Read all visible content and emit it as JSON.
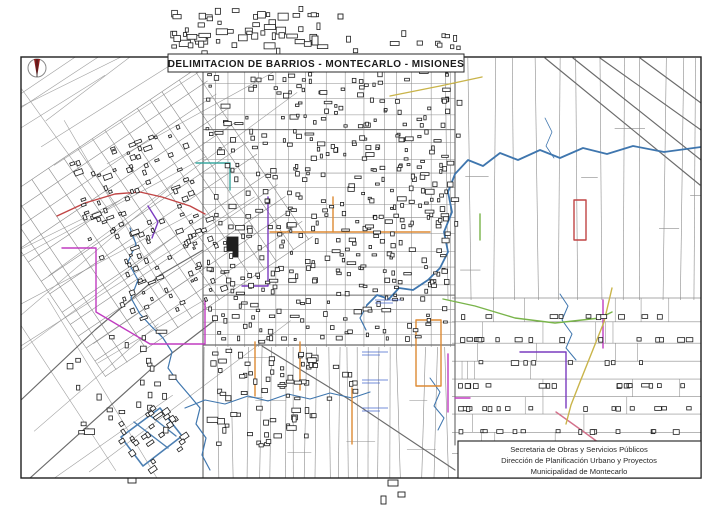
{
  "title": "DELIMITACION DE BARRIOS - MONTECARLO - MISIONES",
  "title_block": {
    "lines": [
      "Secretaria de Obras y Servicios Públicos",
      "Dirección de Planificación Urbano y Proyectos",
      "Municipalidad de Montecarlo"
    ]
  },
  "icons": {
    "north_arrow": "compass-needle-icon"
  },
  "colors": {
    "frame": "#1e1e1e",
    "road": "#8c8c8c",
    "road_major": "#6b6b6b",
    "building": "#1f1f1f",
    "river": "#3f76ae",
    "magenta": "#c03cc0",
    "purple": "#7a3bbf",
    "orange": "#dd8a33",
    "green": "#79b44a",
    "red": "#c04545",
    "pink": "#d4728c",
    "yellow": "#c9b44a",
    "teal": "#3aa8a0",
    "steel": "#4c7fb2",
    "blue_label": "#4466cc",
    "arrow_red": "#8b1c1c"
  },
  "map": {
    "frame": {
      "x": 21,
      "y": 57,
      "w": 680,
      "h": 421
    },
    "regions": [
      {
        "t": "diag",
        "seed": 11,
        "x": 21,
        "y": 58,
        "w": 200,
        "h": 420,
        "angle": -34,
        "n": 24
      },
      {
        "t": "gridr",
        "seed": 7,
        "cx": 152,
        "cy": 222,
        "w": 250,
        "h": 205,
        "angle": -34,
        "cell": 18
      },
      {
        "t": "grid",
        "seed": 3,
        "x": 203,
        "y": 60,
        "w": 252,
        "h": 287,
        "cw": 17,
        "ch": 14
      },
      {
        "t": "vpar",
        "seed": 5,
        "x": 203,
        "y": 347,
        "w": 165,
        "h": 131,
        "sp": 13,
        "tilt": 6
      },
      {
        "t": "vpar",
        "seed": 6,
        "x": 368,
        "y": 347,
        "w": 86,
        "h": 131,
        "sp": 16,
        "tilt": 8
      },
      {
        "t": "vpar",
        "seed": 9,
        "x": 448,
        "y": 58,
        "w": 253,
        "h": 242,
        "sp": 18,
        "tilt": 9
      },
      {
        "t": "hstr",
        "seed": 13,
        "x": 452,
        "y": 298,
        "w": 249,
        "h": 147,
        "rh": 23
      }
    ],
    "major_lines": [
      [
        [
          203,
          345
        ],
        [
          455,
          345
        ]
      ],
      [
        [
          203,
          60
        ],
        [
          203,
          478
        ]
      ],
      [
        [
          455,
          60
        ],
        [
          455,
          445
        ]
      ],
      [
        [
          262,
          346
        ],
        [
          350,
          400
        ],
        [
          455,
          470
        ]
      ],
      [
        [
          21,
          400
        ],
        [
          95,
          330
        ],
        [
          160,
          275
        ],
        [
          203,
          250
        ]
      ],
      [
        [
          30,
          478
        ],
        [
          150,
          370
        ],
        [
          215,
          320
        ]
      ],
      [
        [
          573,
          58
        ],
        [
          701,
          160
        ]
      ],
      [
        [
          600,
          58
        ],
        [
          701,
          130
        ]
      ],
      [
        [
          640,
          58
        ],
        [
          701,
          103
        ]
      ],
      [
        [
          545,
          58
        ],
        [
          700,
          185
        ]
      ]
    ],
    "rivers": [
      {
        "w": 1.8,
        "p": [
          [
            701,
            147
          ],
          [
            664,
            152
          ],
          [
            633,
            146
          ],
          [
            607,
            154
          ],
          [
            583,
            148
          ],
          [
            560,
            158
          ],
          [
            540,
            150
          ],
          [
            518,
            160
          ],
          [
            500,
            153
          ],
          [
            483,
            166
          ],
          [
            468,
            160
          ],
          [
            455,
            174
          ],
          [
            448,
            192
          ],
          [
            452,
            212
          ],
          [
            444,
            232
          ],
          [
            448,
            252
          ],
          [
            440,
            268
          ],
          [
            428,
            280
          ],
          [
            413,
            290
          ],
          [
            399,
            288
          ],
          [
            389,
            299
          ],
          [
            377,
            295
          ],
          [
            367,
            305
          ]
        ]
      },
      {
        "w": 1.2,
        "p": [
          [
            130,
            228
          ],
          [
            136,
            244
          ],
          [
            128,
            262
          ],
          [
            138,
            280
          ],
          [
            131,
            298
          ],
          [
            140,
            314
          ],
          [
            151,
            326
          ],
          [
            163,
            338
          ],
          [
            172,
            352
          ],
          [
            168,
            368
          ],
          [
            178,
            382
          ],
          [
            190,
            396
          ],
          [
            200,
            408
          ],
          [
            196,
            424
          ],
          [
            206,
            438
          ],
          [
            202,
            455
          ],
          [
            210,
            470
          ]
        ]
      },
      {
        "w": 1.1,
        "p": [
          [
            185,
            408
          ],
          [
            205,
            400
          ],
          [
            225,
            404
          ],
          [
            248,
            396
          ],
          [
            268,
            401
          ],
          [
            288,
            394
          ],
          [
            310,
            399
          ],
          [
            330,
            393
          ],
          [
            352,
            398
          ],
          [
            370,
            392
          ]
        ]
      },
      {
        "w": 1.0,
        "p": [
          [
            560,
            294
          ],
          [
            568,
            306
          ],
          [
            562,
            320
          ],
          [
            572,
            334
          ],
          [
            566,
            348
          ],
          [
            576,
            360
          ]
        ]
      },
      {
        "w": 1.0,
        "p": [
          [
            430,
            378
          ],
          [
            440,
            392
          ],
          [
            434,
            406
          ],
          [
            444,
            418
          ],
          [
            438,
            430
          ]
        ]
      },
      {
        "w": 0.8,
        "p": [
          [
            545,
            118
          ],
          [
            552,
            132
          ],
          [
            546,
            146
          ],
          [
            554,
            158
          ]
        ]
      },
      {
        "w": 1.2,
        "p": [
          [
            367,
            305
          ],
          [
            360,
            318
          ],
          [
            366,
            330
          ]
        ]
      }
    ],
    "boundaries": [
      {
        "c": "magenta",
        "p": [
          [
            62,
            248
          ],
          [
            96,
            248
          ],
          [
            96,
            312
          ],
          [
            150,
            344
          ],
          [
            205,
            344
          ],
          [
            205,
            300
          ]
        ]
      },
      {
        "c": "magenta",
        "p": [
          [
            448,
            354
          ],
          [
            448,
            412
          ]
        ]
      },
      {
        "c": "magenta",
        "p": [
          [
            455,
            398
          ],
          [
            470,
            398
          ]
        ]
      },
      {
        "c": "magenta",
        "p": [
          [
            603,
            300
          ],
          [
            603,
            348
          ]
        ]
      },
      {
        "c": "purple",
        "p": [
          [
            268,
            197
          ],
          [
            268,
            286
          ],
          [
            242,
            286
          ]
        ]
      },
      {
        "c": "purple",
        "p": [
          [
            520,
            352
          ],
          [
            566,
            352
          ],
          [
            566,
            408
          ]
        ]
      },
      {
        "c": "purple",
        "p": [
          [
            148,
            206
          ],
          [
            158,
            222
          ],
          [
            152,
            238
          ]
        ]
      },
      {
        "c": "orange",
        "p": [
          [
            270,
            232
          ],
          [
            430,
            232
          ]
        ]
      },
      {
        "c": "orange",
        "p": [
          [
            333,
            197
          ],
          [
            333,
            232
          ]
        ]
      },
      {
        "c": "orange",
        "closed": true,
        "p": [
          [
            416,
            320
          ],
          [
            441,
            320
          ],
          [
            441,
            386
          ],
          [
            416,
            386
          ]
        ]
      },
      {
        "c": "orange",
        "p": [
          [
            352,
            388
          ],
          [
            352,
            444
          ]
        ]
      },
      {
        "c": "orange",
        "p": [
          [
            255,
            342
          ],
          [
            255,
            396
          ]
        ]
      },
      {
        "c": "orange",
        "p": [
          [
            300,
            342
          ],
          [
            300,
            390
          ]
        ]
      },
      {
        "c": "green",
        "p": [
          [
            443,
            299
          ],
          [
            475,
            306
          ],
          [
            515,
            318
          ],
          [
            555,
            323
          ],
          [
            600,
            318
          ],
          [
            612,
            312
          ]
        ]
      },
      {
        "c": "green",
        "p": [
          [
            480,
            214
          ],
          [
            480,
            240
          ]
        ]
      },
      {
        "c": "red",
        "p": [
          [
            57,
            216
          ],
          [
            85,
            203
          ],
          [
            115,
            194
          ],
          [
            140,
            192
          ],
          [
            162,
            197
          ],
          [
            190,
            206
          ],
          [
            205,
            214
          ]
        ]
      },
      {
        "c": "red",
        "closed": true,
        "p": [
          [
            574,
            200
          ],
          [
            586,
            200
          ],
          [
            586,
            240
          ],
          [
            574,
            240
          ]
        ]
      },
      {
        "c": "pink",
        "p": [
          [
            556,
            412
          ],
          [
            584,
            432
          ],
          [
            606,
            448
          ]
        ]
      },
      {
        "c": "yellow",
        "p": [
          [
            390,
            96
          ],
          [
            440,
            86
          ],
          [
            482,
            77
          ]
        ]
      },
      {
        "c": "yellow",
        "p": [
          [
            612,
            288
          ],
          [
            604,
            322
          ],
          [
            592,
            352
          ],
          [
            580,
            382
          ],
          [
            571,
            405
          ],
          [
            566,
            424
          ]
        ]
      },
      {
        "c": "teal",
        "p": [
          [
            196,
            163
          ],
          [
            230,
            163
          ],
          [
            230,
            190
          ]
        ]
      },
      {
        "c": "steel",
        "closed": true,
        "w": 1.6,
        "p": [
          [
            121,
            437
          ],
          [
            160,
            408
          ],
          [
            182,
            436
          ],
          [
            143,
            466
          ]
        ]
      },
      {
        "c": "steel",
        "p": [
          [
            134,
            422
          ],
          [
            168,
            448
          ]
        ]
      },
      {
        "c": "steel",
        "p": [
          [
            147,
            413
          ],
          [
            176,
            436
          ]
        ]
      }
    ],
    "building_zones": [
      {
        "x": 206,
        "y": 64,
        "w": 246,
        "h": 280,
        "n": 400,
        "min": 2,
        "max": 5,
        "seed": 21
      },
      {
        "x": 88,
        "y": 138,
        "w": 128,
        "h": 180,
        "n": 120,
        "min": 2,
        "max": 5,
        "seed": 22,
        "angle": -20
      },
      {
        "x": 170,
        "y": 6,
        "w": 160,
        "h": 50,
        "n": 55,
        "min": 3,
        "max": 7,
        "seed": 23
      },
      {
        "x": 335,
        "y": 22,
        "w": 135,
        "h": 33,
        "n": 12,
        "min": 3,
        "max": 6,
        "seed": 24
      },
      {
        "x": 206,
        "y": 348,
        "w": 115,
        "h": 105,
        "n": 55,
        "min": 3,
        "max": 6,
        "seed": 25
      },
      {
        "x": 458,
        "y": 302,
        "w": 238,
        "h": 140,
        "n": 80,
        "min": 3,
        "max": 5,
        "seed": 26,
        "rows": 23
      },
      {
        "x": 438,
        "y": 75,
        "w": 26,
        "h": 170,
        "n": 14,
        "min": 3,
        "max": 6,
        "seed": 27
      },
      {
        "x": 60,
        "y": 330,
        "w": 120,
        "h": 108,
        "n": 26,
        "min": 3,
        "max": 6,
        "seed": 28
      },
      {
        "x": 115,
        "y": 405,
        "w": 72,
        "h": 62,
        "n": 26,
        "min": 3,
        "max": 6,
        "seed": 29,
        "angle": -35
      },
      {
        "x": 250,
        "y": 352,
        "w": 110,
        "h": 60,
        "n": 20,
        "min": 2,
        "max": 5,
        "seed": 30
      }
    ],
    "extra_buildings": [
      [
        227,
        237,
        11,
        14,
        "f"
      ],
      [
        233,
        251,
        5,
        6,
        "f"
      ],
      [
        128,
        478,
        8,
        5
      ],
      [
        388,
        480,
        10,
        6
      ],
      [
        398,
        492,
        7,
        5
      ],
      [
        381,
        496,
        5,
        8
      ],
      [
        312,
        36,
        6,
        9
      ],
      [
        338,
        14,
        5,
        5
      ]
    ],
    "blue_labels": [
      [
        362,
        352
      ],
      [
        362,
        380
      ],
      [
        362,
        408
      ],
      [
        375,
        300
      ]
    ]
  }
}
